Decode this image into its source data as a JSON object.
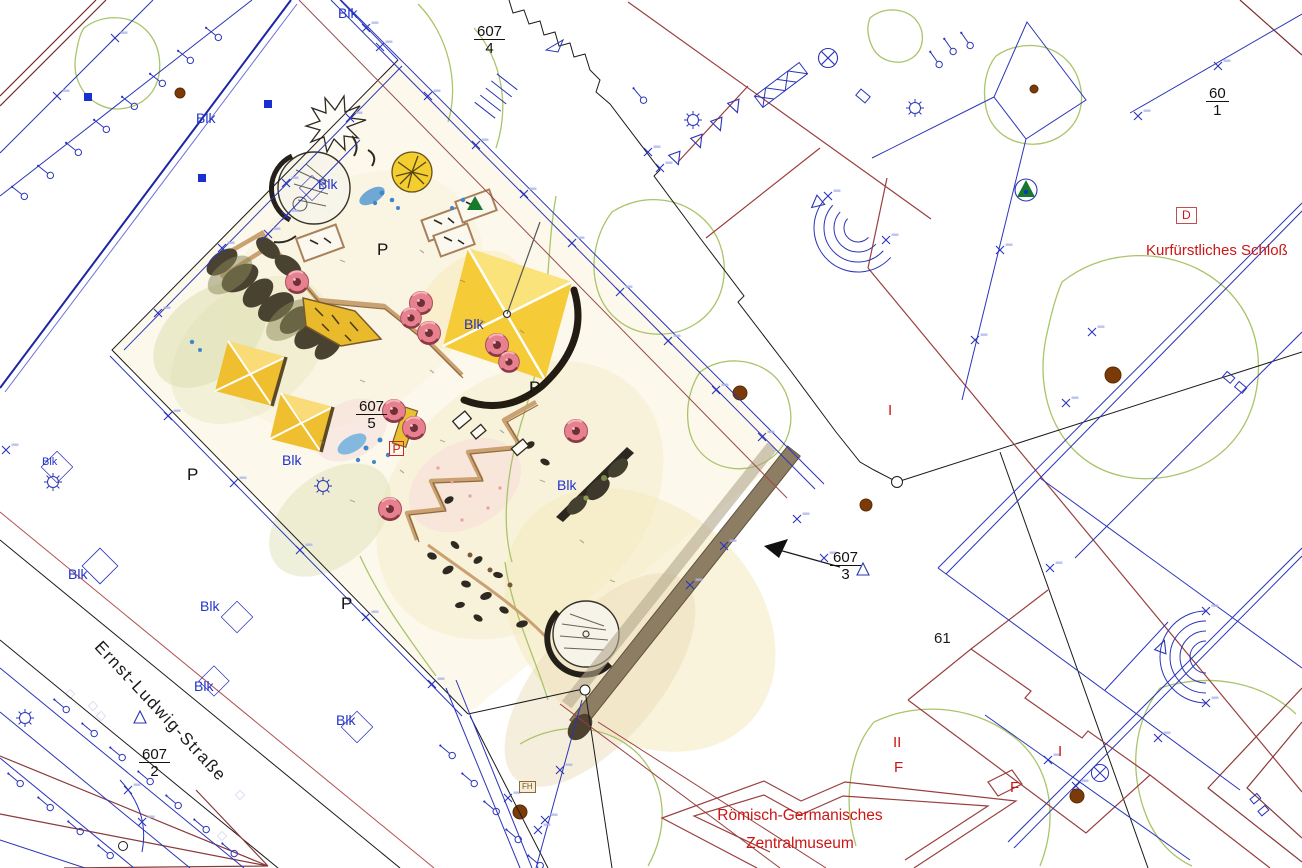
{
  "labels": {
    "blk": "Blk",
    "parking": "P",
    "parking_boxed": "P",
    "d_marker": "D",
    "fh_marker": "FH",
    "street": "Ernst-Ludwig-Straße",
    "schloss": "Kurfürstliches Schloß",
    "museum_line1": "Römisch-Germanisches",
    "museum_line2": "Zentralmuseum",
    "storeys_one": "I",
    "storeys_two": "II",
    "wing": "F",
    "parcel_61": "61"
  },
  "parcels": {
    "p607_4": {
      "num": "607",
      "den": "4"
    },
    "p607_5": {
      "num": "607",
      "den": "5"
    },
    "p607_2": {
      "num": "607",
      "den": "2"
    },
    "p607_3": {
      "num": "607",
      "den": "3"
    },
    "p60_1": {
      "num": "60",
      "den": "1"
    }
  },
  "colors": {
    "survey_blue": "#2a35b8",
    "parcel_black": "#1a1a1a",
    "building_red": "#9a3f3f",
    "label_red": "#cc1515",
    "tree_green": "#a9c46a",
    "canopy_yellow": "#f2c62e",
    "seat_pink": "#e8818f",
    "wall_tan": "#c9a06a",
    "path_taupe": "#8d7d62",
    "earth_brown": "#7a3b08"
  },
  "symbols": {
    "lamp_post": "lamp-post",
    "survey_cross": "survey-cross-mark",
    "survey_diamond": "survey-diamond",
    "sun_gear": "streetlight-symbol",
    "circle_cross": "survey-point",
    "tree_dot": "tree-trunk-dot"
  }
}
